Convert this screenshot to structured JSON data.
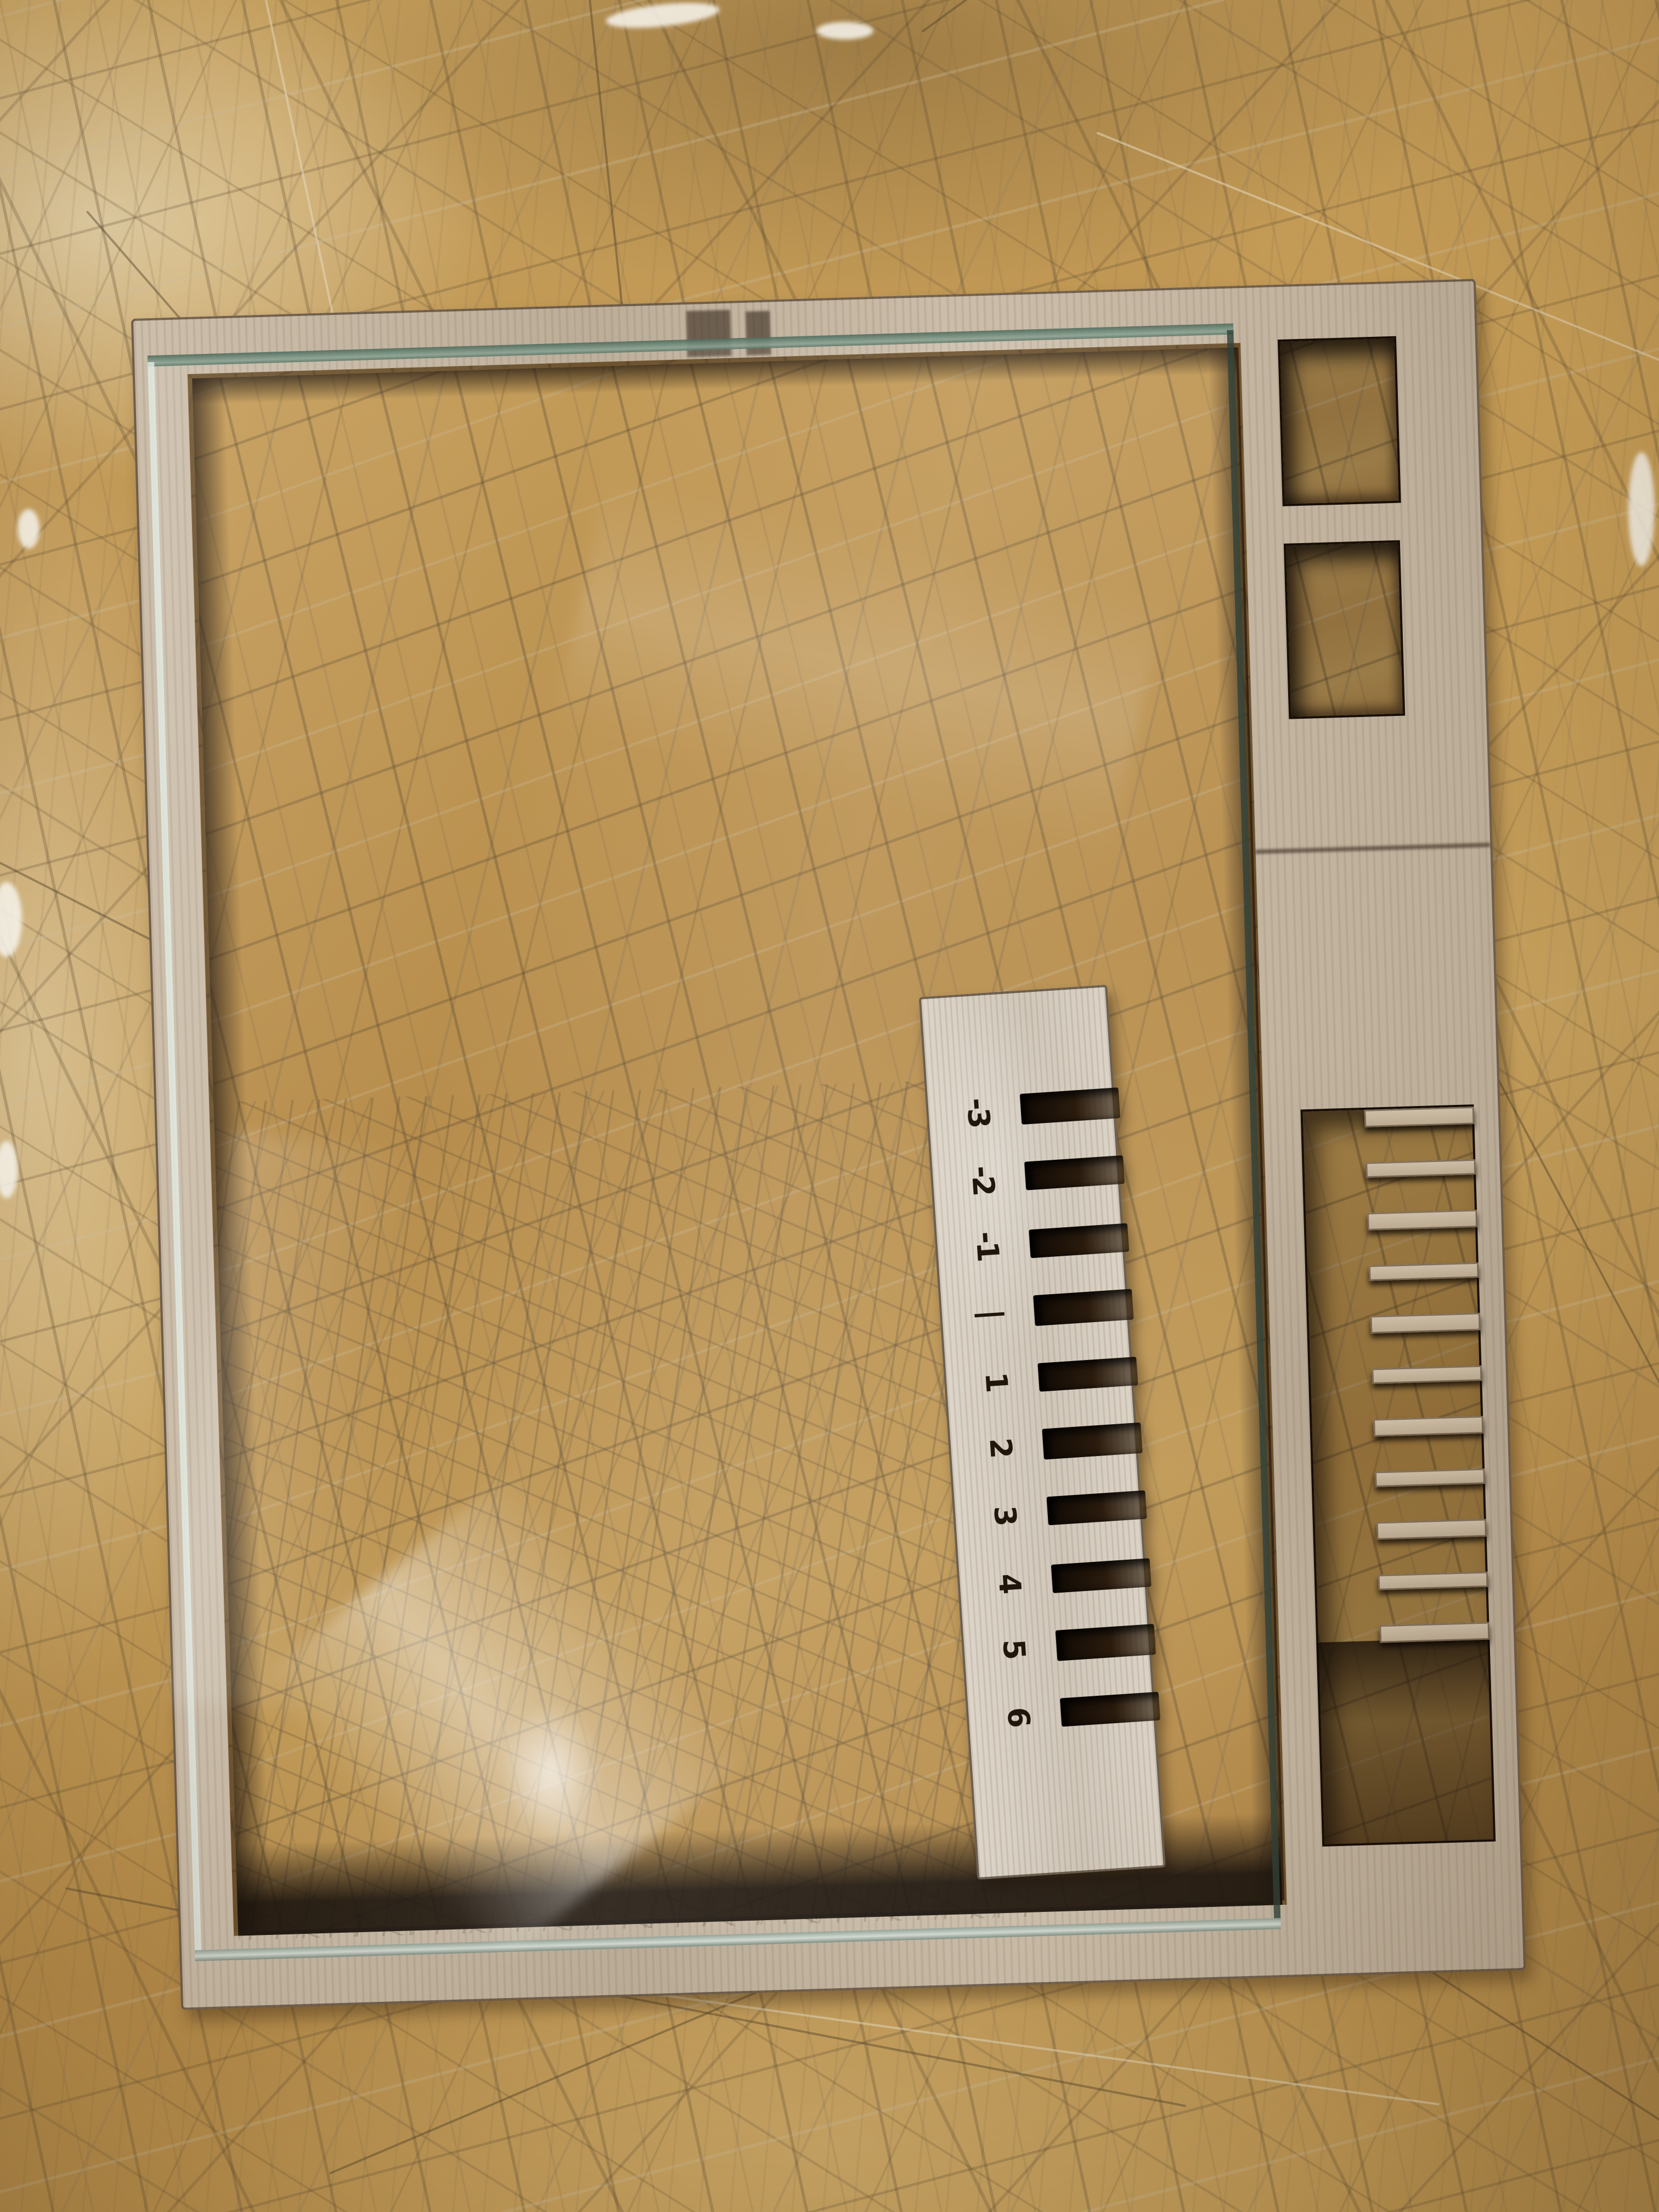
{
  "image_type": "photograph",
  "scene": {
    "subject": "Laser-cut plywood frame with a glass pane and a numbered kerf-gauge comb",
    "surface": "heavily scratched plywood workbench"
  },
  "kerf_gauge": {
    "labels": [
      "-3",
      "-2",
      "-1",
      "|",
      "1",
      "2",
      "3",
      "4",
      "5",
      "6"
    ],
    "slot_count": 10
  },
  "frame": {
    "small_holes": 2,
    "comb_tooth_count": 11
  },
  "colors": {
    "bench_wood": "#c49a58",
    "frame_wood": "#c6b7a1",
    "gauge_wood": "#d8cfc1",
    "glass_edge_green": "#6b8577",
    "cut_edge_shadow": "#1a0f07",
    "engraved_digits": "#20160c"
  }
}
